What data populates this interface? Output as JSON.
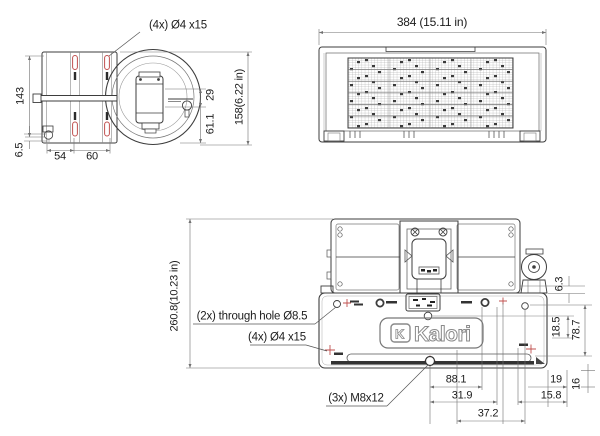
{
  "colors": {
    "part_line": "#3d3d3d",
    "dim_line": "#707070",
    "accent_red": "#c0504f",
    "text": "#1c1c1c",
    "background": "#ffffff"
  },
  "side_view": {
    "callout_slots": "(4x) Ø4 x15",
    "dim_body_height": "143",
    "dim_drain_offset": "6.5",
    "dim_slot_spacing_1": "54",
    "dim_slot_spacing_2": "60",
    "dim_motor_top": "29",
    "dim_axis_height": "61.1",
    "dim_overall_height": "158(6.22 in)"
  },
  "front_view": {
    "dim_overall_width": "384 (15.11 in)"
  },
  "bottom_view": {
    "dim_overall_depth": "260.8(10.23 in)",
    "callout_through_hole": "(2x) through hole Ø8.5",
    "callout_slots": "(4x) Ø4 x15",
    "callout_studs": "(3x) M8x12",
    "brand": "Kalori",
    "brand_monogram": "K",
    "dim_gap": "6.3",
    "dim_hole_offset": "18.5",
    "dim_hole_span": "78.7",
    "dim_stud_edge": "19",
    "dim_corner_offset": "16",
    "dim_stud_spacing": "88.1",
    "dim_hole_a": "31.9",
    "dim_hole_b": "15.8",
    "dim_hole_c": "37.2"
  }
}
